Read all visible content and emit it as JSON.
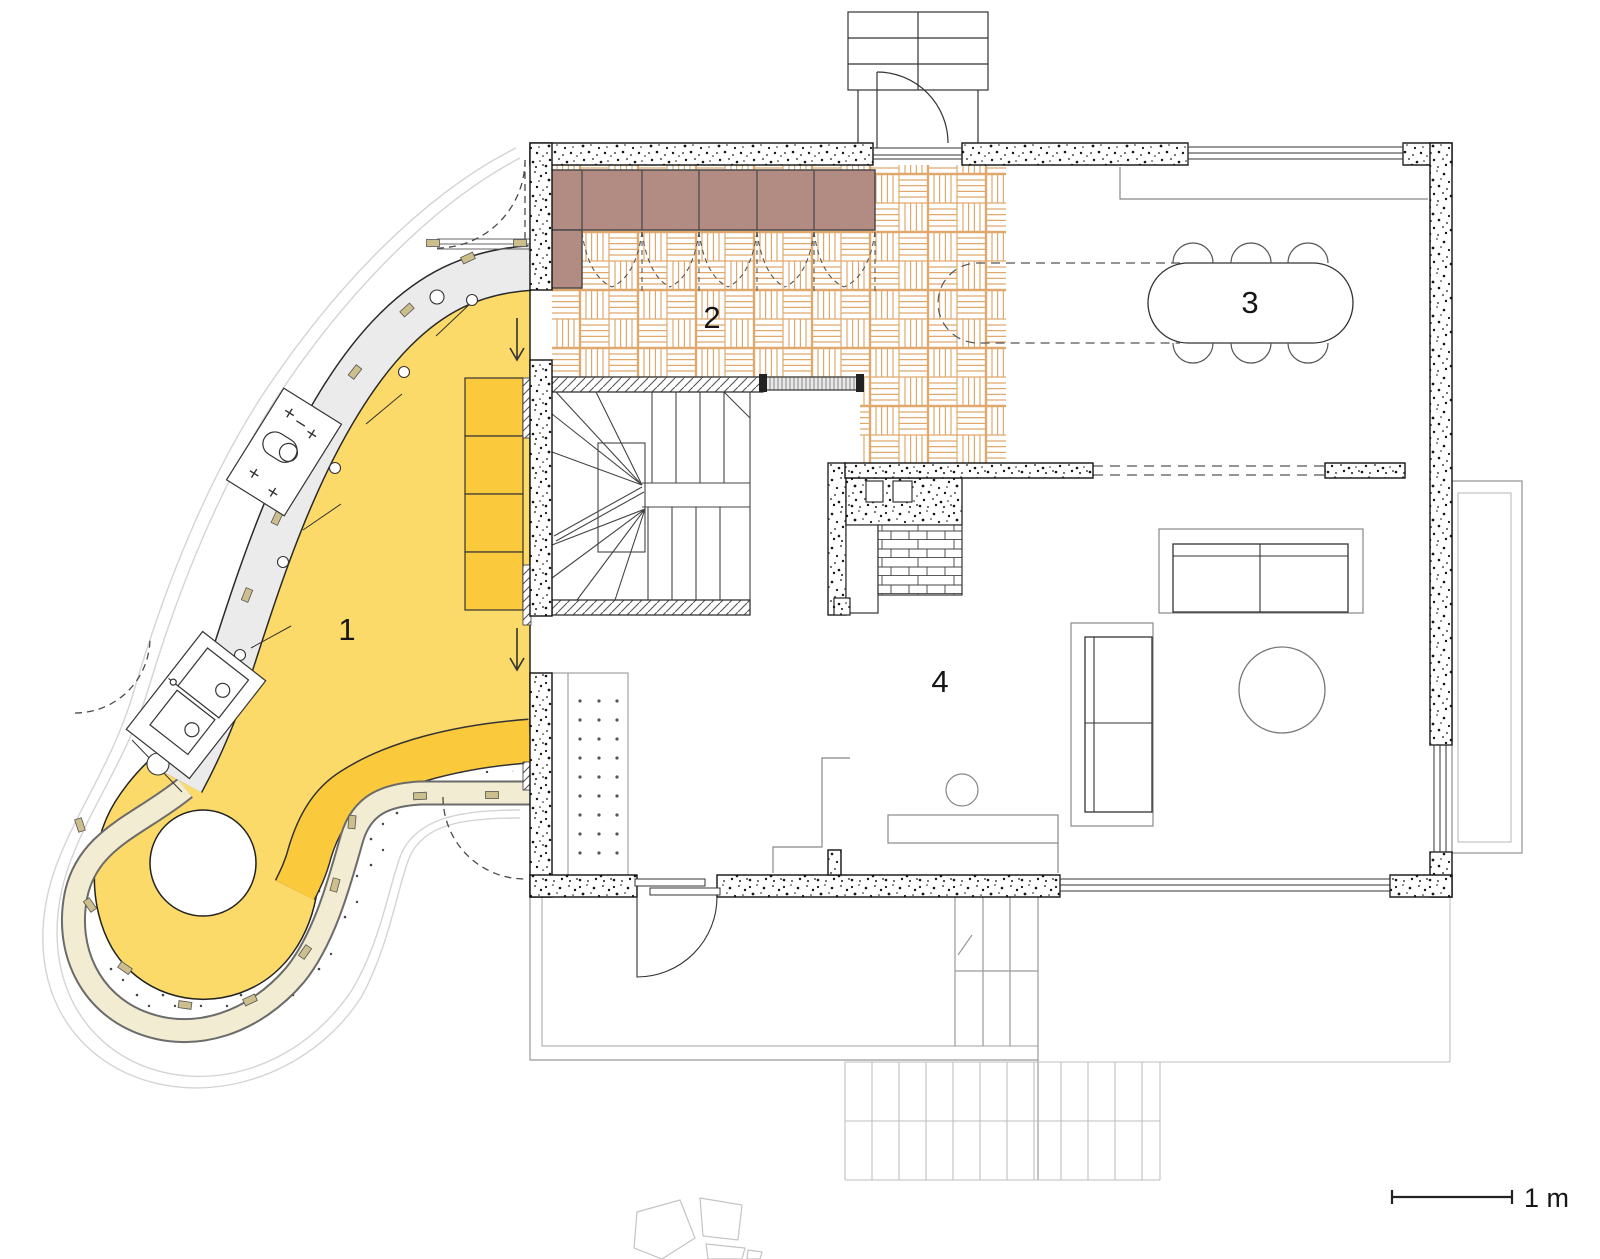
{
  "labels": {
    "room1": "1",
    "room2": "2",
    "room3": "3",
    "room4": "4"
  },
  "scale": {
    "label": "1 m"
  },
  "colors": {
    "room1_floor": "#FBDA69",
    "room1_accent": "#FBC93C",
    "cream_band": "#F2ECD2",
    "counter_grey": "#EBEBEB",
    "wardrobe": "#B28C82",
    "parquet_line": "#DFA96E",
    "wall_ink": "#111111",
    "site_grey": "#BFBFBF",
    "dash_grey": "#4a4a4a"
  }
}
